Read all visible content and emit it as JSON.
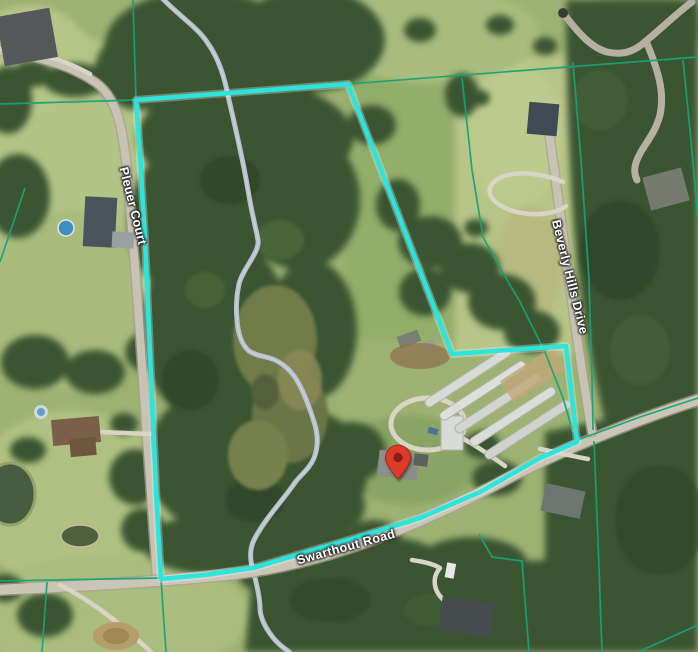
{
  "map": {
    "labels": {
      "road_left": "Pleuer Court",
      "road_right": "Beverly Hills Drive",
      "road_bottom": "Swarthout Road"
    },
    "marker": {
      "icon": "location-pin-icon"
    },
    "colors": {
      "parcel_highlight": "#2ce4dc",
      "parcel_lines": "#18a377",
      "stream": "#b6bfca",
      "pin": "#dd3a2b",
      "pin_inner": "#8a1d12"
    }
  }
}
